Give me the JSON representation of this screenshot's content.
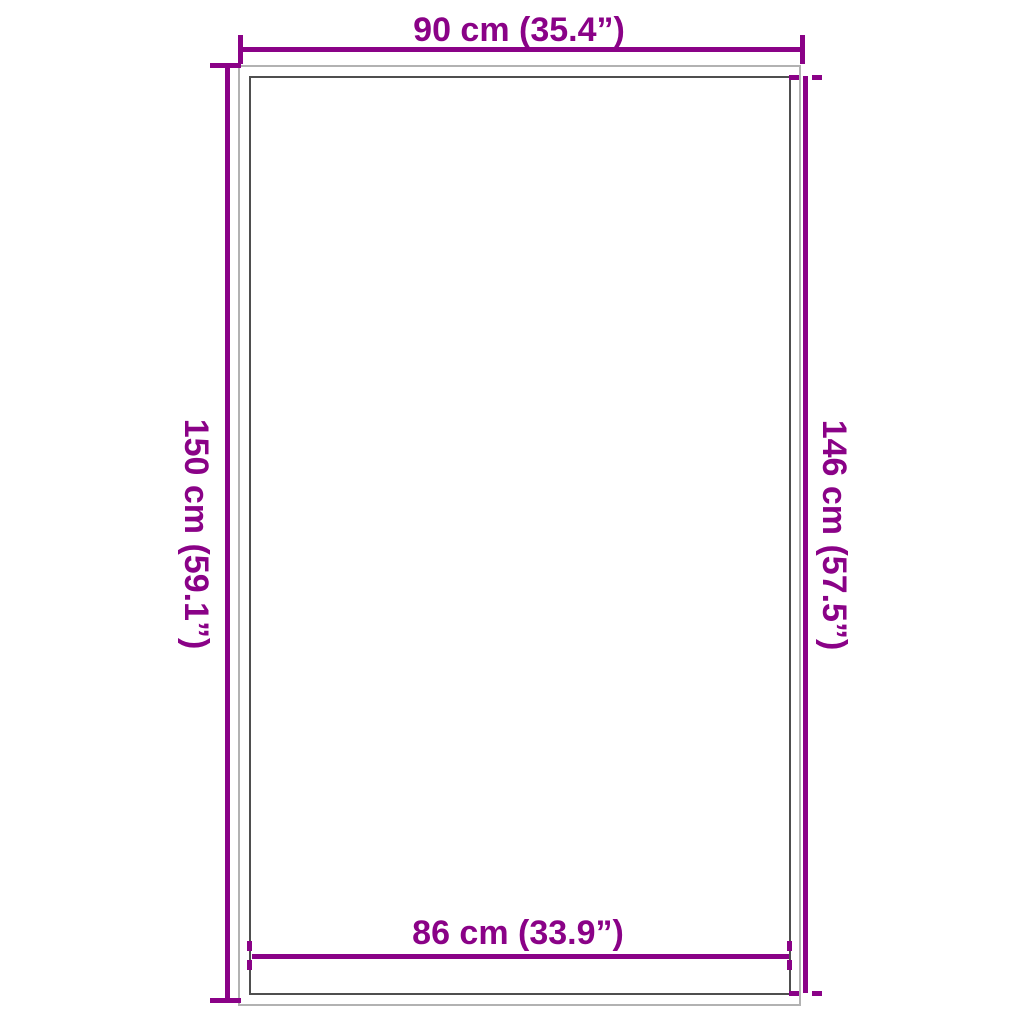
{
  "diagram": {
    "colors": {
      "accent": "#8A0287",
      "outer_outline": "#B2B2B2",
      "inner_outline": "#4F4F4F",
      "background": "#FFFFFF"
    },
    "dimensions": {
      "top_width": "90 cm (35.4”)",
      "left_height": "150 cm (59.1”)",
      "right_inner_height": "146 cm (57.5”)",
      "bottom_inner_width": "86 cm (33.9”)"
    }
  }
}
